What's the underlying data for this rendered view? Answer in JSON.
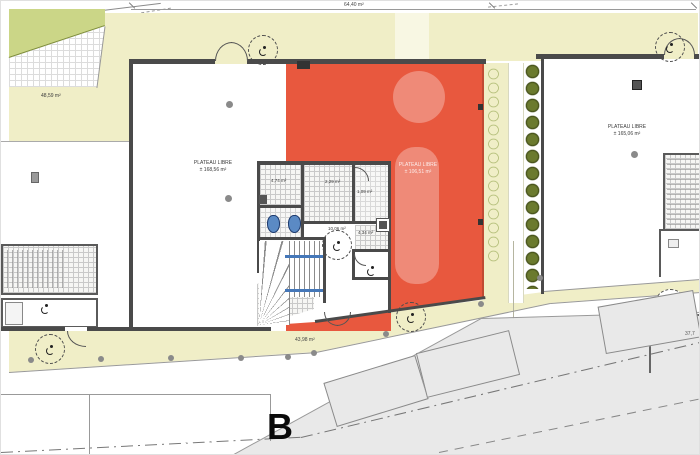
{
  "plan": {
    "section_letter": "B",
    "top_dimension": "64,40 m²",
    "terrace_area": "48,59 m²",
    "walkway_area": "43,98 m²",
    "right_edge_dimension": "37,7",
    "units": {
      "left": {
        "name": "PLATEAU LIBRE",
        "area": "± 168,56 m²"
      },
      "selected": {
        "name": "PLATEAU LIBRE",
        "area": "± 106,51 m²"
      },
      "right": {
        "name": "PLATEAU LIBRE",
        "area": "± 165,06 m²"
      }
    },
    "core_rooms": [
      {
        "area": "4,74 m²"
      },
      {
        "area": "2,29 m²"
      },
      {
        "area": "1,09 m²"
      },
      {
        "area": "10,06 m²"
      },
      {
        "area": "4,34 m²"
      }
    ],
    "icons": {
      "accessibility": "wheelchair-icon"
    },
    "colors": {
      "plan_yellow": "#f0eec7",
      "selected_red": "#e8583e",
      "green_area": "#cbd687",
      "bush_dark": "#5f6e25",
      "road_gray": "#e9e9e9",
      "wall_dark": "#4a4a4a",
      "fixture_blue": "#4577b8"
    }
  }
}
